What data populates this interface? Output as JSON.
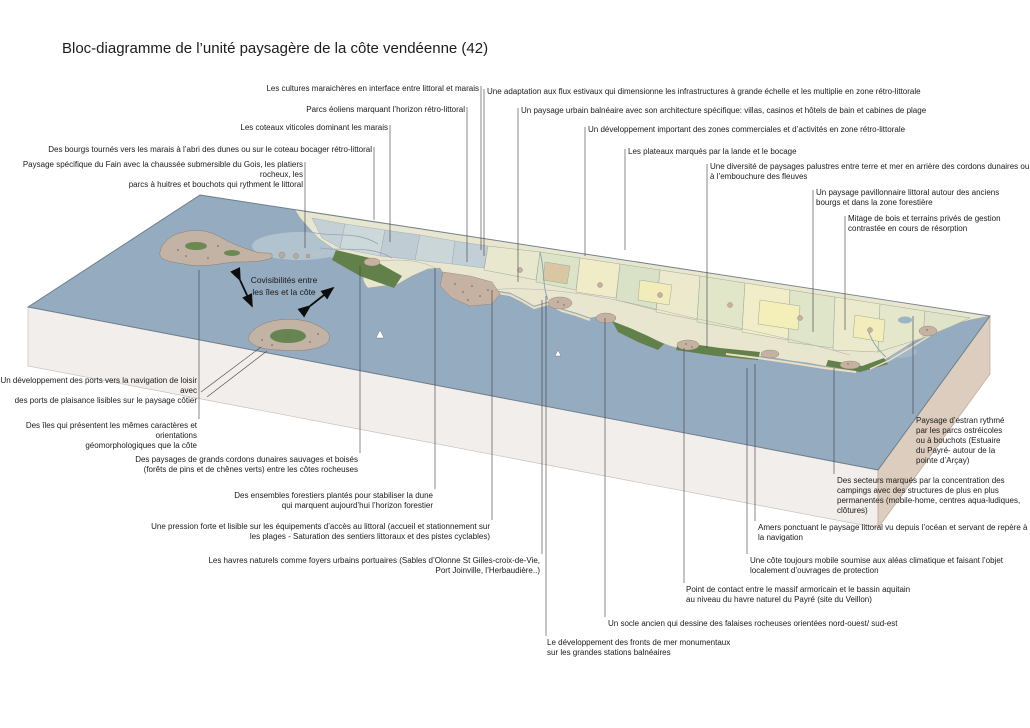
{
  "title": "Bloc-diagramme de l’unité paysagère de la côte vendéenne (42)",
  "map_label": {
    "covisibilites": "Covisibilités entre\nles îles et la côte"
  },
  "annotations": {
    "cultures_maraicheres": "Les cultures maraichères en interface entre littoral et marais",
    "parcs_eoliens": "Parcs éoliens marquant l’horizon rétro-littoral",
    "coteaux_viticoles": "Les coteaux viticoles dominant les marais",
    "bourgs_tournes": "Des bourgs tournés vers les marais à l’abri des dunes ou sur le coteau bocager rétro-littoral",
    "fain_gois": "Paysage spécifique du Fain avec la chaussée submersible du Gois, les platiers rocheux, les\nparcs à huitres et bouchots qui rythment le littoral",
    "adaptation_flux": "Une adaptation aux flux estivaux qui dimensionne les infrastructures à grande échelle et les multiplie en zone rétro-littorale",
    "paysage_urbain": "Un paysage urbain balnéaire avec son architecture spécifique: villas, casinos et hôtels de bain et cabines de plage",
    "dev_commercial": "Un développement important des zones commerciales et d’activités en zone rétro-littorale",
    "plateaux": "Les plateaux marqués par la lande et le bocage",
    "diversite_palustres": "Une diversité de paysages palustres entre terre et mer en arrière des cordons dunaires ou\nà l’embouchure des fleuves",
    "pavillonnaire": "Un paysage pavillonnaire littoral autour des anciens\nbourgs et dans la zone forestière",
    "mitage": "Mitage de bois et terrains privés de gestion\ncontrastée en cours de résorption",
    "dev_ports": "Un développement des ports vers la navigation de loisir avec\ndes ports de plaisance lisibles sur le paysage côtier",
    "des_iles": "Des îles qui présentent les mêmes caractères et orientations\ngéomorphologiques que la côte",
    "cordons_dunaires": "Des paysages de grands cordons dunaires sauvages et boisés\n(forêts de pins et de chênes verts) entre les côtes rocheuses",
    "ensembles_forestiers": "Des ensembles forestiers plantés pour stabiliser la dune\nqui marquent aujourd’hui l’horizon forestier",
    "pression_acces": "Une pression forte et lisible sur les équipements d’accès au littoral (accueil et stationnement sur\nles plages - Saturation des sentiers littoraux et des pistes cyclables)",
    "havres_naturels": "Les havres naturels comme foyers urbains portuaires (Sables d’Olonne St Gilles-croix-de-Vie,\nPort Joinville, l’Herbaudière..)",
    "fronts_de_mer": "Le développement des fronts de mer monumentaux\nsur les grandes stations balnéaires",
    "socle_ancien": "Un socle ancien qui dessine des falaises rocheuses orientées nord-ouest/ sud-est",
    "point_contact": "Point de contact entre le massif armoricain et le bassin aquitain\nau niveau du havre naturel du Payré (site du Veillon)",
    "cote_mobile": "Une côte toujours mobile soumise aux aléas climatique et faisant l’objet\nlocalement d’ouvrages de protection",
    "amers": "Amers ponctuant le paysage littoral vu depuis l’océan et servant de repère à\nla navigation",
    "secteurs_campings": "Des secteurs marqués par la concentration des\ncampings avec des structures de plus en plus\npermanentes (mobile-home, centres aqua-ludiques,\nclôtures)",
    "estran": "Paysage d’estran rythmé\npar les parcs ostréicoles\nou à bouchots (Estuaire\ndu Payré- autour de la\npointe d’Arçay)"
  },
  "palette": {
    "ocean": "#95abc0",
    "shallow": "#b7c7d2",
    "land": "#e9e6d0",
    "marais": "#c2ced6",
    "forest": "#62804a",
    "town": "#c6b2a2",
    "front_face": "#f2eeeb",
    "side_face": "#dccdbf",
    "leader_line": "#444444"
  }
}
